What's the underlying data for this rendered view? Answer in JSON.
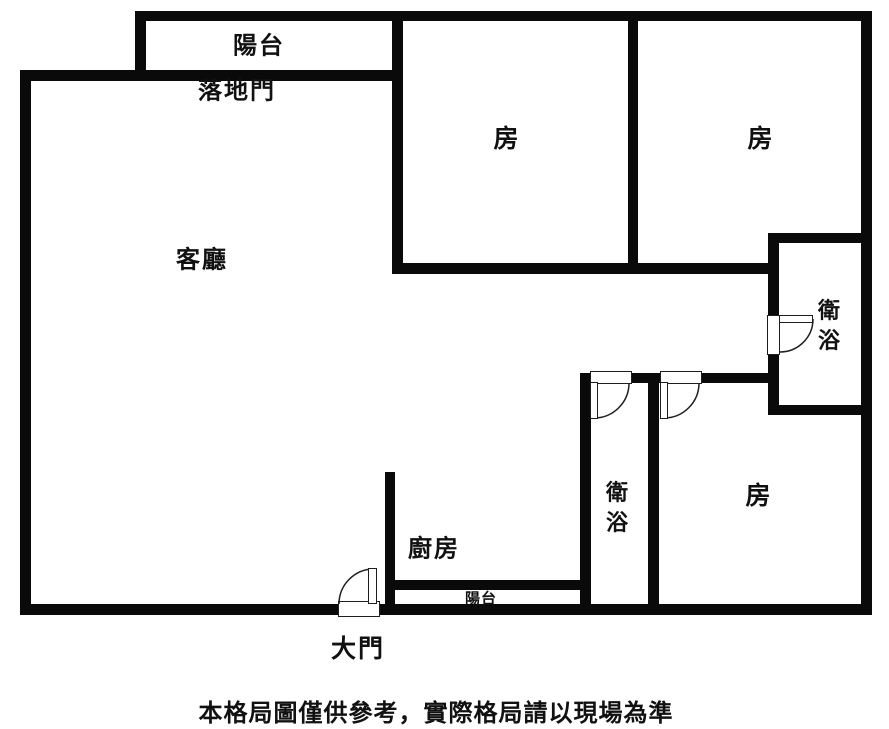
{
  "colors": {
    "wall": "#0a0a0a",
    "background": "#ffffff",
    "text": "#111111"
  },
  "labels": {
    "balcony_top": "陽台",
    "sliding_door": "落地門",
    "living_room": "客廳",
    "room_top_center": "房",
    "room_top_right": "房",
    "bathroom_right": "衛浴",
    "bathroom_center": "衛浴",
    "room_bottom_right": "房",
    "kitchen": "廚房",
    "balcony_bottom": "陽台",
    "main_door": "大門",
    "disclaimer": "本格局圖僅供參考，實際格局請以現場為準"
  }
}
